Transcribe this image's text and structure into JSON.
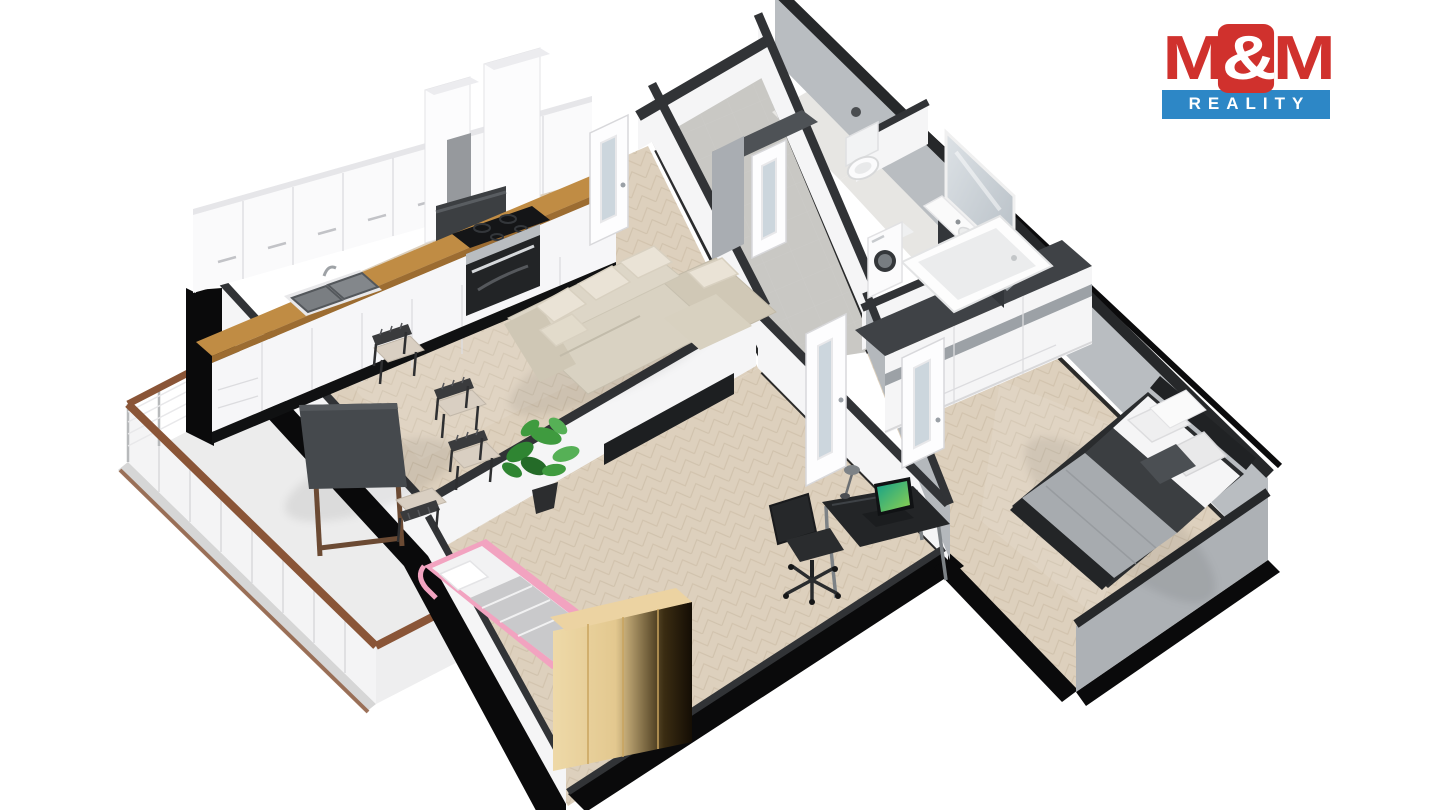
{
  "page": {
    "background": "#ffffff"
  },
  "logo": {
    "m_left": "M",
    "amp": "&",
    "m_right": "M",
    "line2": "REALITY",
    "red": "#d0312d",
    "blue": "#2d87c6",
    "text_white": "#ffffff"
  },
  "scene": {
    "type": "3d-floor-plan-render",
    "colors": {
      "parquet": "#ddd0bd",
      "parquet_line": "#c8b8a0",
      "tile_hall": "#c9c8c4",
      "tile_bath": "#e7e6e3",
      "wall_white": "#f5f5f6",
      "wall_gray": "#b9bdc1",
      "wall_cap": "#313336",
      "wall_cap_dark": "#26282a",
      "wall_black": "#0a0a0b",
      "counter_wood": "#c08c44",
      "wardrobe_wood": "#ecd3a2",
      "rail_brown": "#8a5537",
      "sofa_beige": "#d9d2c2",
      "pink": "#f2a3c0",
      "plant_green": "#3f9b3f",
      "bed_duvet_gray": "#a7abaf",
      "bed_throw_dark": "#3b3e41",
      "furniture_dark": "#232527"
    },
    "rooms": [
      {
        "name": "living-room-with-kitchen",
        "items": [
          "kitchen-cabinets",
          "kitchen-counter",
          "sink",
          "cooktop",
          "oven",
          "range-hood",
          "corner-sofa",
          "dining-table",
          "dining-chairs",
          "potted-plant",
          "tv-sideboard"
        ]
      },
      {
        "name": "balcony",
        "items": [
          "railing"
        ]
      },
      {
        "name": "kids-room",
        "items": [
          "single-bed-pink",
          "wooden-wardrobe",
          "desk",
          "office-chair",
          "laptop",
          "desk-lamp"
        ]
      },
      {
        "name": "hallway",
        "items": [
          "interior-doors"
        ]
      },
      {
        "name": "wc",
        "items": [
          "toilet"
        ]
      },
      {
        "name": "bathroom",
        "items": [
          "washing-machine",
          "bathtub",
          "vanity-with-sink",
          "mirror"
        ]
      },
      {
        "name": "bedroom",
        "items": [
          "double-bed",
          "white-wardrobe"
        ]
      }
    ]
  }
}
